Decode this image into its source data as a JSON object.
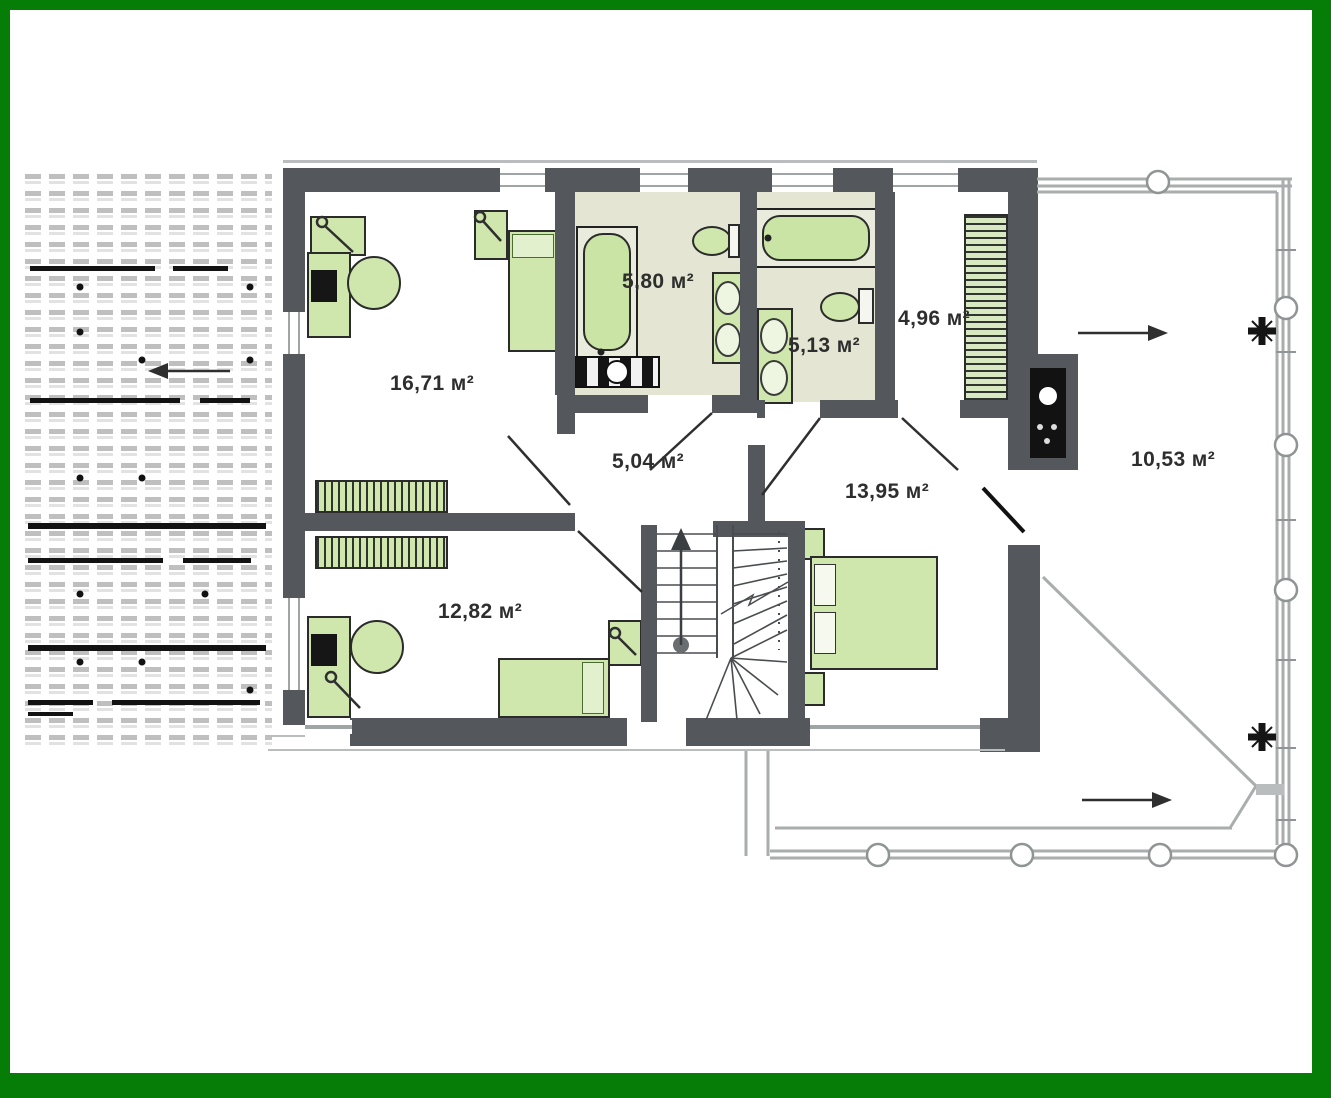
{
  "plan": {
    "type": "floor-plan-second-storey",
    "unit_suffix": "м²",
    "rooms": [
      {
        "id": "bedroom-top-left",
        "area_label": "16,71 м²"
      },
      {
        "id": "bathroom-center",
        "area_label": "5,80 м²"
      },
      {
        "id": "bathroom-right",
        "area_label": "5,13 м²"
      },
      {
        "id": "closet",
        "area_label": "4,96 м²"
      },
      {
        "id": "hall",
        "area_label": "5,04 м²"
      },
      {
        "id": "bedroom-right",
        "area_label": "13,95 м²"
      },
      {
        "id": "bedroom-bottom-left",
        "area_label": "12,82 м²"
      },
      {
        "id": "terrace",
        "area_label": "10,53 м²"
      }
    ],
    "icons": {
      "roof-hatch": "dashed-tile-pattern",
      "left-arrow": "←",
      "right-arrow": "→",
      "stair-up-arrow": "↑",
      "railing-post": "circle",
      "drain-cross": "✛",
      "door-leaf": "diagonal-line"
    },
    "colors": {
      "frame_green": "#067d06",
      "wall_gray": "#54575b",
      "furniture_green": "#cfe7ad",
      "bath_floor": "#e4e6d3",
      "railing_gray": "#a9adad",
      "label_text": "#2e2e2e"
    }
  }
}
